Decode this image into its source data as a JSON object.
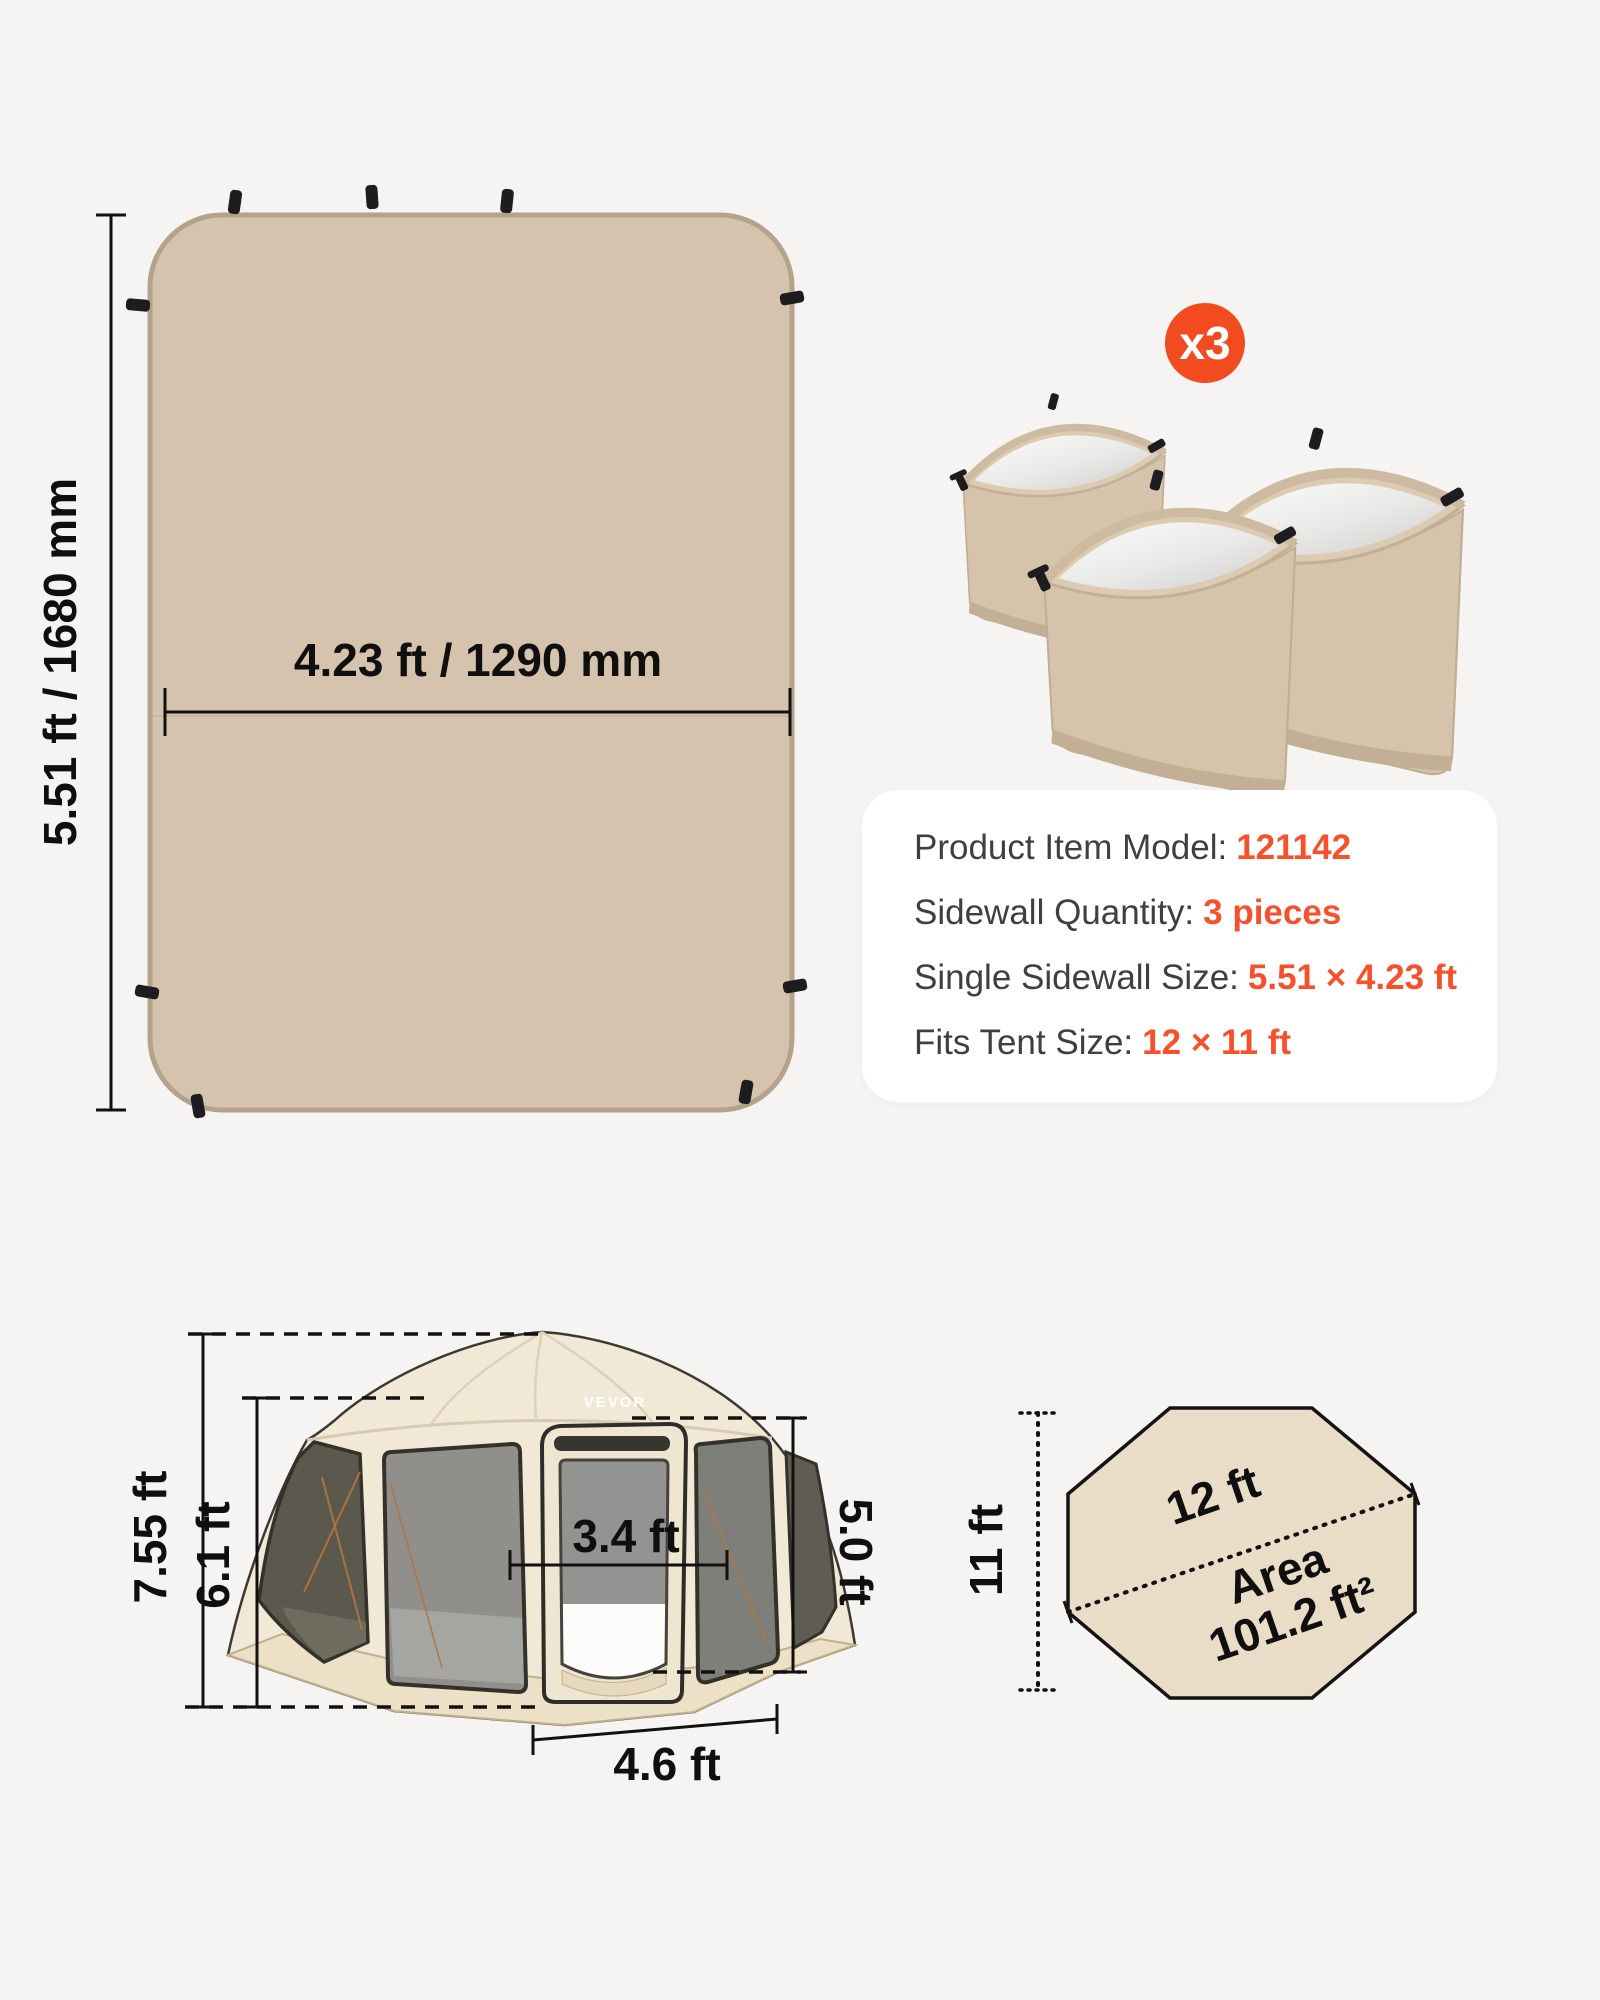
{
  "title": "Tent sidewall dimensions infographic",
  "colors": {
    "background": "#F5F4F2",
    "accent_orange": "#F7502B",
    "badge_orange": "#F24B20",
    "panel_tan": "#D5C3AE",
    "panel_border": "#B4A28B",
    "octagon_fill": "#E9DDC8",
    "card_background": "#FFFFFF",
    "spec_label_gray": "#3F3F41",
    "dimension_text": "#0F0F0F"
  },
  "sidewall_panel": {
    "height_label": "5.51 ft / 1680 mm",
    "width_label": "4.23 ft / 1290 mm"
  },
  "quantity_badge": {
    "label": "x3"
  },
  "spec_card": {
    "rows": [
      {
        "label": "Product Item Model:",
        "value": "121142"
      },
      {
        "label": "Sidewall Quantity:",
        "value": "3 pieces"
      },
      {
        "label": "Single Sidewall Size:",
        "value": "5.51 × 4.23 ft"
      },
      {
        "label": "Fits Tent Size:",
        "value": "12 × 11 ft"
      }
    ]
  },
  "tent": {
    "brand": "VEVOR",
    "total_height": "7.55 ft",
    "wall_height": "6.1 ft",
    "door_width": "3.4 ft",
    "door_height": "5.0 ft",
    "panel_width": "4.6 ft"
  },
  "footprint": {
    "width_label": "12 ft",
    "depth_label": "11 ft",
    "area_title": "Area",
    "area_value": "101.2 ft²"
  }
}
